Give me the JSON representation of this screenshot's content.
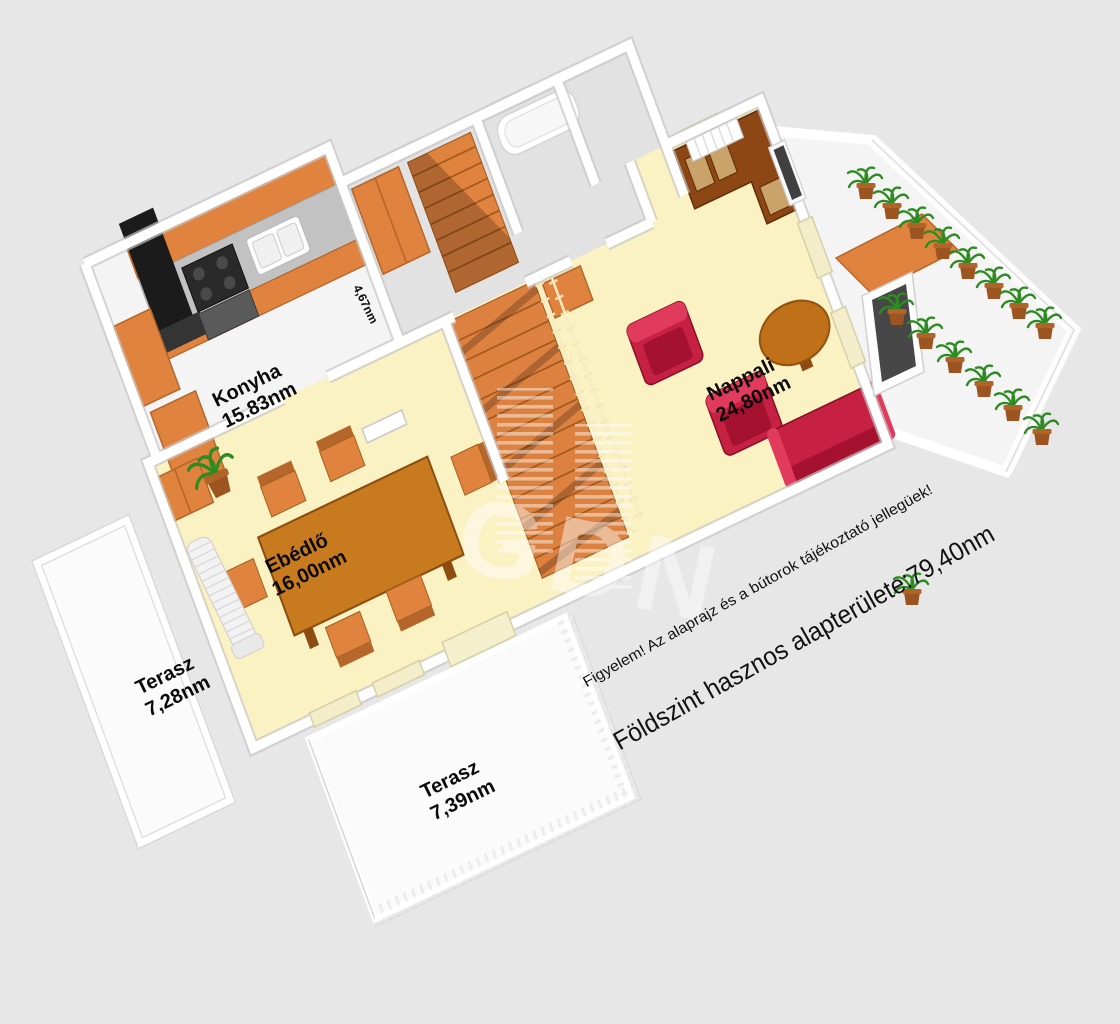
{
  "scene": {
    "type": "3d-floorplan-render",
    "width": 1120,
    "height": 1024
  },
  "watermark": {
    "text": "GDN"
  },
  "labels": {
    "konyha": {
      "name": "Konyha",
      "area": "15.83nm"
    },
    "nappali": {
      "name": "Nappali",
      "area": "24,80nm"
    },
    "ebedlo": {
      "name": "Ebédlő",
      "area": "16,00nm"
    },
    "terasz_oldalso": {
      "name": "Terasz",
      "area": "7,28nm"
    },
    "terasz_also": {
      "name": "Terasz",
      "area": "7,39nm"
    },
    "lepcsohaz": {
      "area": "4,67nm"
    }
  },
  "annotations": {
    "disclaimer": "Figyelem! Az alaprajz és a bútorok tájékoztató jellegüek!",
    "total_area": "Földszint hasznos alapterülete:79,40nm"
  },
  "colors": {
    "background": "#e7e7e7",
    "wall": "#ffffff",
    "wall_shadow": "#c6c6c6",
    "floor_room": "#fbf2c3",
    "floor_gray": "#e2e2e2",
    "floor_white": "#f4f4f4",
    "orange": "#e0833f",
    "orange_dark": "#b5662a",
    "wood": "#c87a1e",
    "wood_dark": "#8d4d10",
    "cabinet_dark": "#8c4715",
    "red": "#c62043",
    "red_dark": "#a5122f",
    "green": "#2e8b22",
    "pot": "#9c5420",
    "text": "#0a0a0a"
  }
}
